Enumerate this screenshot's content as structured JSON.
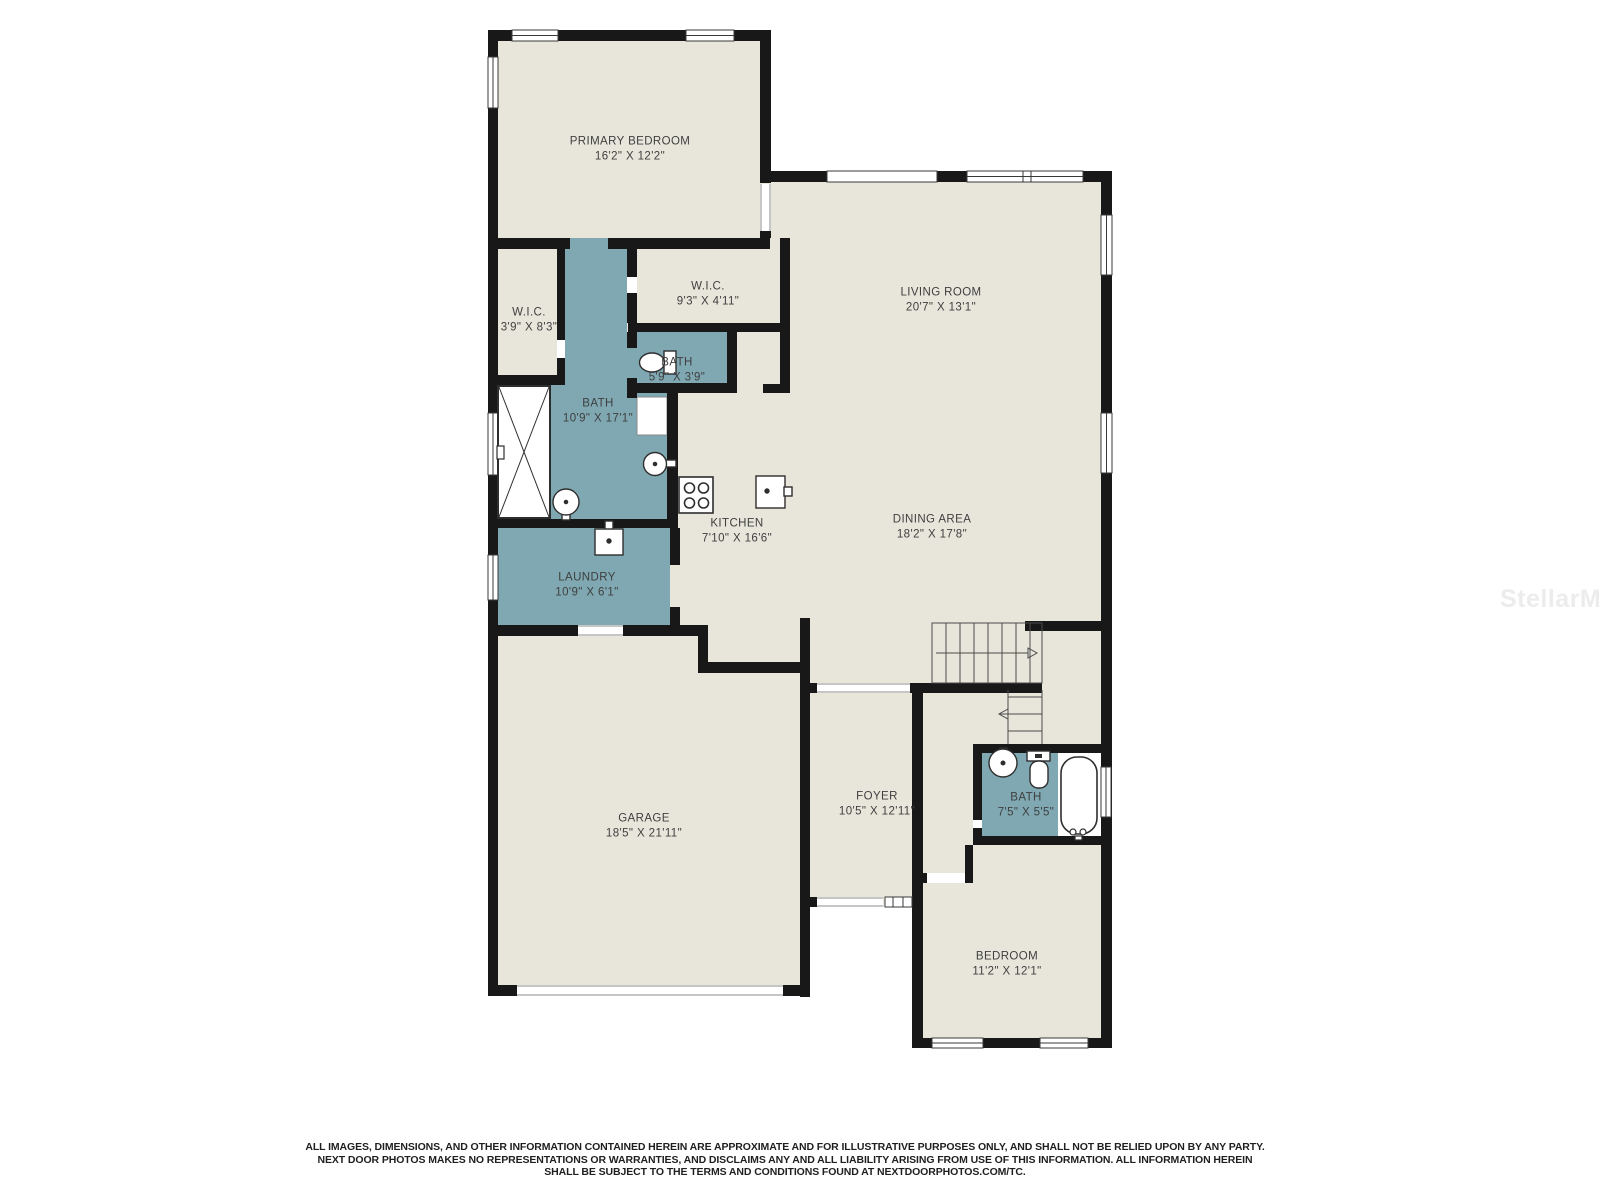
{
  "colors": {
    "floor": "#e8e6db",
    "wet_room": "#7fa8b2",
    "wall": "#181818",
    "label_text": "#3f3f3f",
    "watermark_text": "#ececec"
  },
  "floorplan": {
    "watermark": "StellarMLS",
    "rooms": [
      {
        "id": "primary-bedroom",
        "name": "PRIMARY BEDROOM",
        "dims": "16'2\" X 12'2\""
      },
      {
        "id": "wic-primary",
        "name": "W.I.C.",
        "dims": "3'9\" X 8'3\""
      },
      {
        "id": "wic-2",
        "name": "W.I.C.",
        "dims": "9'3\" X 4'11\""
      },
      {
        "id": "bath-small",
        "name": "BATH",
        "dims": "5'9\" X 3'9\""
      },
      {
        "id": "bath-primary",
        "name": "BATH",
        "dims": "10'9\" X 17'1\""
      },
      {
        "id": "living-room",
        "name": "LIVING ROOM",
        "dims": "20'7\" X 13'1\""
      },
      {
        "id": "kitchen",
        "name": "KITCHEN",
        "dims": "7'10\" X 16'6\""
      },
      {
        "id": "dining-area",
        "name": "DINING AREA",
        "dims": "18'2\" X 17'8\""
      },
      {
        "id": "laundry",
        "name": "LAUNDRY",
        "dims": "10'9\" X 6'1\""
      },
      {
        "id": "garage",
        "name": "GARAGE",
        "dims": "18'5\" X 21'11\""
      },
      {
        "id": "foyer",
        "name": "FOYER",
        "dims": "10'5\" X 12'11\""
      },
      {
        "id": "bath-hall",
        "name": "BATH",
        "dims": "7'5\" X 5'5\""
      },
      {
        "id": "bedroom",
        "name": "BEDROOM",
        "dims": "11'2\" X 12'1\""
      }
    ],
    "disclaimer": {
      "line1": "ALL IMAGES, DIMENSIONS, AND OTHER INFORMATION CONTAINED HEREIN ARE APPROXIMATE AND FOR ILLUSTRATIVE PURPOSES ONLY, AND SHALL NOT BE RELIED UPON BY ANY PARTY.",
      "line2": "NEXT DOOR PHOTOS MAKES NO REPRESENTATIONS OR WARRANTIES, AND DISCLAIMS ANY AND ALL LIABILITY ARISING FROM USE OF THIS INFORMATION. ALL INFORMATION HEREIN",
      "line3": "SHALL BE SUBJECT TO THE TERMS AND CONDITIONS FOUND AT NEXTDOORPHOTOS.COM/TC."
    }
  }
}
